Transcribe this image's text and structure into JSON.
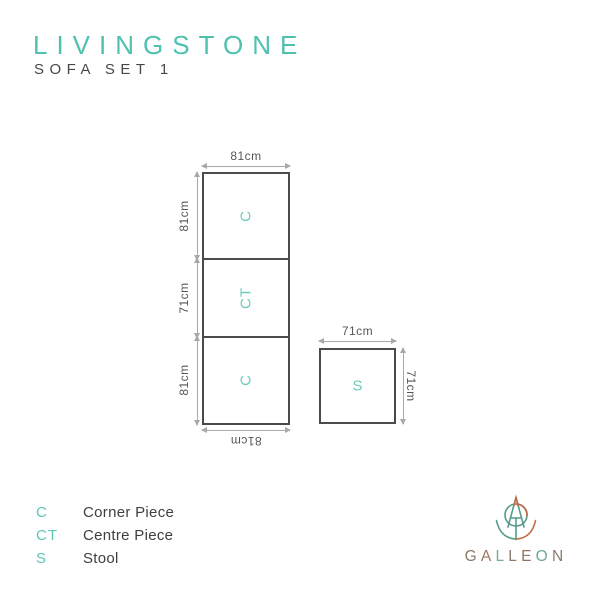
{
  "title": "LIVINGSTONE",
  "subtitle": "SOFA SET 1",
  "colors": {
    "accent_teal": "#4FC1AF",
    "piece_letter_teal": "#6FC9B8",
    "box_border": "#4A4B4D",
    "dimension_line": "#A7A9AC",
    "dimension_text": "#55565A",
    "dark_text": "#3F4043",
    "logo_teal": "#559C8B",
    "logo_orange": "#C26A45",
    "logo_text_brown": "#8B7A6A"
  },
  "diagram": {
    "sofa": {
      "width_label": "81cm",
      "bottom_width_label": "81cm",
      "pieces": [
        {
          "label": "C",
          "height_label": "81cm"
        },
        {
          "label": "CT",
          "height_label": "71cm"
        },
        {
          "label": "C",
          "height_label": "81cm"
        }
      ]
    },
    "stool": {
      "label": "S",
      "width_label": "71cm",
      "height_label": "71cm"
    }
  },
  "legend": {
    "items": [
      {
        "abbr": "C",
        "name": "Corner Piece"
      },
      {
        "abbr": "CT",
        "name": "Centre Piece"
      },
      {
        "abbr": "S",
        "name": "Stool"
      }
    ]
  },
  "logo": {
    "name": "GALLEON",
    "letters": [
      {
        "char": "G",
        "color": "#8B7A6A"
      },
      {
        "char": "A",
        "color": "#A0765D"
      },
      {
        "char": "L",
        "color": "#7FA697"
      },
      {
        "char": "L",
        "color": "#8B7A6A"
      },
      {
        "char": "E",
        "color": "#93755F"
      },
      {
        "char": "O",
        "color": "#6FA897"
      },
      {
        "char": "N",
        "color": "#8B7A6A"
      }
    ]
  }
}
